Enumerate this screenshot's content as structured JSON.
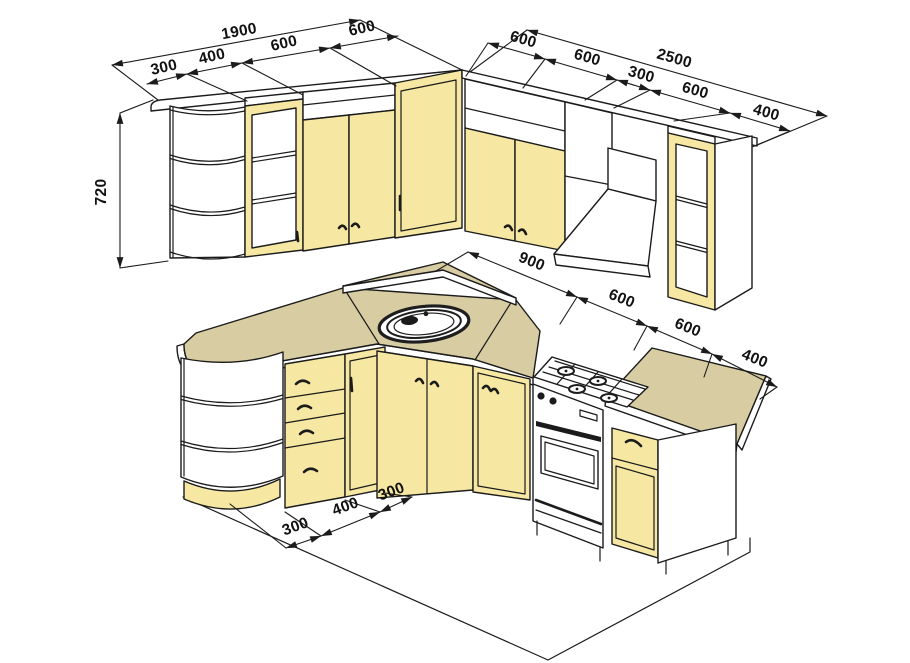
{
  "drawing": {
    "kind": "kitchen-cabinet-isometric-drawing",
    "units": "mm"
  },
  "dims": {
    "left_overall": "1900",
    "left_segments": [
      "300",
      "400",
      "600",
      "600"
    ],
    "right_overall": "2500",
    "right_segments": [
      "600",
      "600",
      "300",
      "600",
      "400"
    ],
    "upper_height": "720",
    "counter_segments": [
      "900",
      "600",
      "600",
      "400"
    ],
    "floor_segments": [
      "300",
      "400",
      "300"
    ]
  },
  "colors": {
    "cabinet_front": "#f6e8a3",
    "countertop": "#d8cda2",
    "outline": "#1b1b1b",
    "text": "#111111",
    "background": "#ffffff"
  }
}
